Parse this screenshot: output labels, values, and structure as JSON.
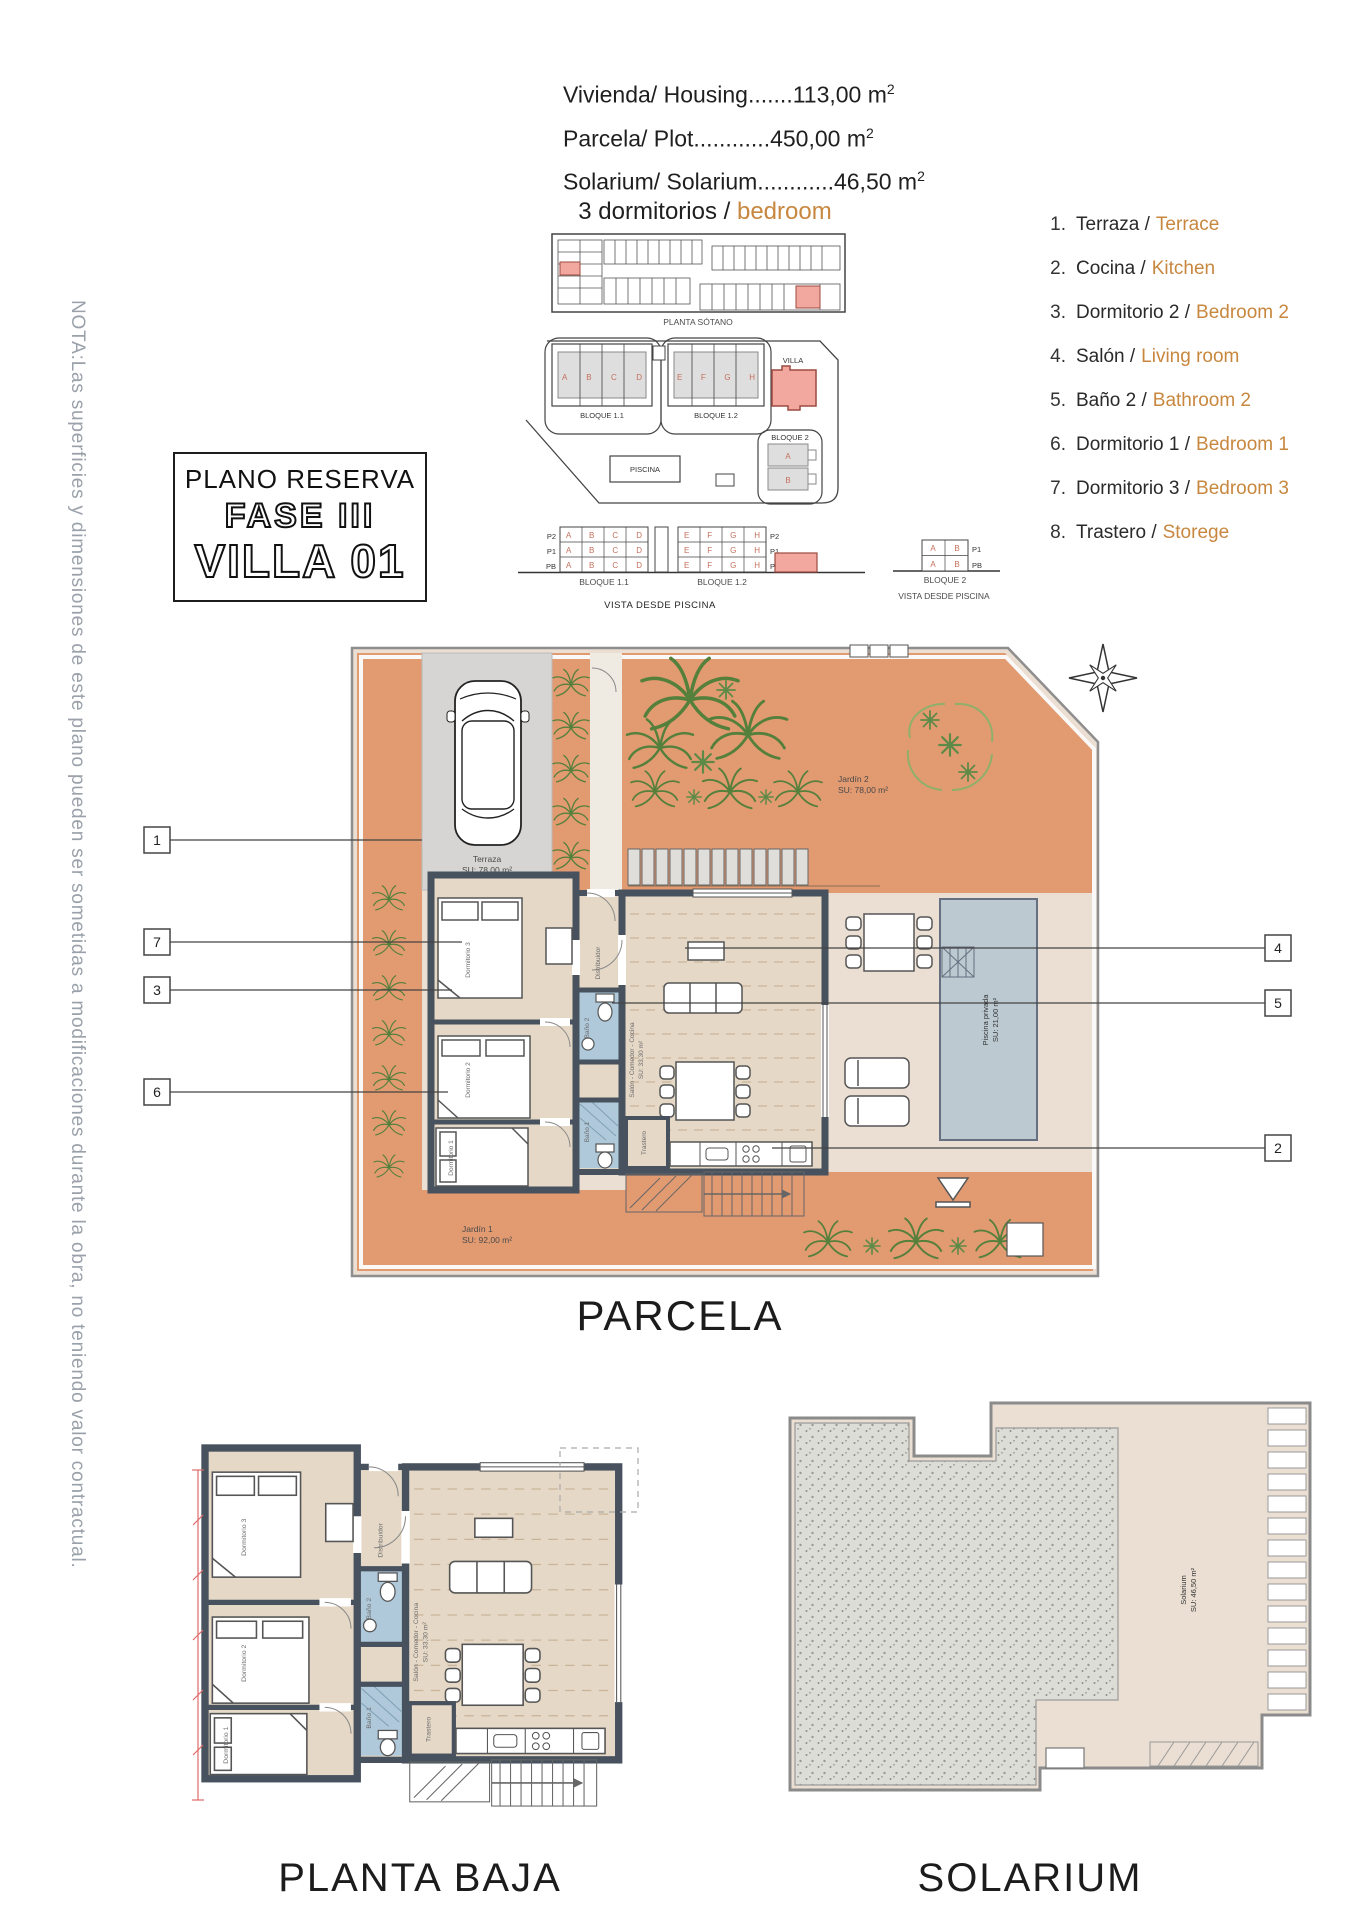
{
  "colors": {
    "accent_orange": "#C8873F",
    "terracotta": "#E29A71",
    "wall_slate": "#47525E",
    "bath_blue": "#AFC9DA",
    "pool_blue": "#BCC9D1",
    "highlight_red": "#F2A89E",
    "note_gray": "#9AA1AA"
  },
  "header": {
    "areas": [
      {
        "text": "Vivienda/ Housing.......113,00 m",
        "sup": "2"
      },
      {
        "text": "Parcela/ Plot............450,00 m",
        "sup": "2"
      },
      {
        "text": "Solarium/ Solarium............46,50 m",
        "sup": "2"
      }
    ],
    "bedrooms_es": "3 dormitorios / ",
    "bedrooms_en": "bedroom"
  },
  "note": "NOTA:Las superficies y dimensiones de este plano pueden ser sometidas a modificaciones durante la obra, no teniendo valor contractual.",
  "title_box": {
    "line1": "PLANO RESERVA",
    "line2": "FASE III",
    "line3": "VILLA 01"
  },
  "legend": [
    {
      "num": "1.",
      "es": "Terraza /",
      "en": "Terrace"
    },
    {
      "num": "2.",
      "es": "Cocina /",
      "en": "Kitchen"
    },
    {
      "num": "3.",
      "es": "Dormitorio 2 /",
      "en": "Bedroom 2"
    },
    {
      "num": "4.",
      "es": "Salón /",
      "en": "Living room"
    },
    {
      "num": "5.",
      "es": "Baño 2 /",
      "en": "Bathroom 2"
    },
    {
      "num": "6.",
      "es": "Dormitorio 1 /",
      "en": "Bedroom 1"
    },
    {
      "num": "7.",
      "es": "Dormitorio 3 /",
      "en": "Bedroom 3"
    },
    {
      "num": "8.",
      "es": "Trastero /",
      "en": "Storege"
    }
  ],
  "site": {
    "sotano_label": "PLANTA SÓTANO",
    "bloque11": "BLOQUE 1.1",
    "bloque12": "BLOQUE 1.2",
    "bloque2": "BLOQUE 2",
    "villa": "VILLA",
    "piscina": "PISCINA",
    "vista": "VISTA DESDE PISCINA",
    "row_abcd": "A B C D",
    "row_efgh": "E F G H",
    "floors": [
      "P2",
      "P1",
      "PB"
    ],
    "floors2": [
      "P1",
      "PB"
    ],
    "unit_a": "A",
    "unit_b": "B"
  },
  "parcela": {
    "title": "PARCELA",
    "callouts": {
      "c1": "1",
      "c7": "7",
      "c3": "3",
      "c6": "6",
      "c4": "4",
      "c5": "5",
      "c2": "2"
    },
    "ground": {
      "terraza": "Terraza",
      "terraza_su": "SU: 78,00 m²",
      "jardin2": "Jardín 2",
      "jardin2_su": "SU: 78,00 m²",
      "jardin1": "Jardín 1",
      "jardin1_su": "SU: 92,00 m²",
      "piscina": "Piscina privada",
      "piscina_su": "SU: 21,00 m²"
    },
    "rooms": {
      "salon": "Salón - Comedor - Cocina",
      "salon_su": "SU: 33,30 m²",
      "dorm1": "Dormitorio 1",
      "dorm2": "Dormitorio 2",
      "dorm3": "Dormitorio 3",
      "bano1": "Baño 1",
      "bano2": "Baño 2",
      "distribuidor": "Distribuidor",
      "trastero": "Trastero"
    }
  },
  "planta_baja": {
    "title": "PLANTA BAJA"
  },
  "solarium": {
    "title": "SOLARIUM",
    "label": "Solarium",
    "label_su": "SU: 46,50 m²"
  }
}
